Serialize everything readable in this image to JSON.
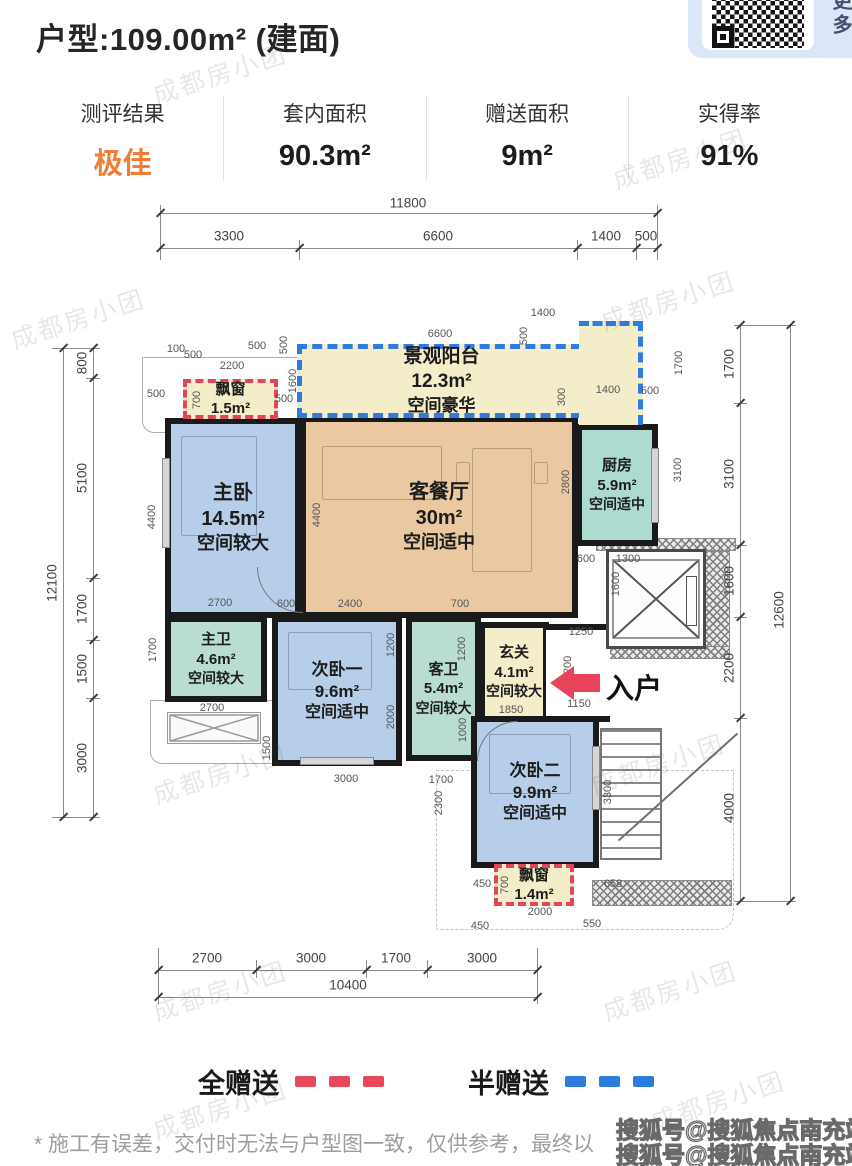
{
  "watermark_text": "成都房小团",
  "header": {
    "title": "户型:109.00m² (建面)",
    "qr_caption": "查更多"
  },
  "stats": {
    "items": [
      {
        "label": "测评结果",
        "value": "极佳",
        "color": "#ee7d35"
      },
      {
        "label": "套内面积",
        "value": "90.3m²"
      },
      {
        "label": "赠送面积",
        "value": "9m²"
      },
      {
        "label": "实得率",
        "value": "91%"
      }
    ]
  },
  "floorplan": {
    "entry_label": "入户",
    "rooms": {
      "balcony": {
        "name": "景观阳台",
        "area": "12.3m²",
        "note": "空间豪华"
      },
      "bay_top": {
        "name": "飘窗",
        "area": "1.5m²"
      },
      "master": {
        "name": "主卧",
        "area": "14.5m²",
        "note": "空间较大"
      },
      "living": {
        "name": "客餐厅",
        "area": "30m²",
        "note": "空间适中"
      },
      "kitchen": {
        "name": "厨房",
        "area": "5.9m²",
        "note": "空间适中"
      },
      "master_bath": {
        "name": "主卫",
        "area": "4.6m²",
        "note": "空间较大"
      },
      "bedroom2": {
        "name": "次卧一",
        "area": "9.6m²",
        "note": "空间适中"
      },
      "guest_bath": {
        "name": "客卫",
        "area": "5.4m²",
        "note": "空间较大"
      },
      "foyer": {
        "name": "玄关",
        "area": "4.1m²",
        "note": "空间较大"
      },
      "bedroom3": {
        "name": "次卧二",
        "area": "9.9m²",
        "note": "空间适中"
      },
      "bay_bottom": {
        "name": "飘窗",
        "area": "1.4m²"
      }
    },
    "dim_lines": [
      {
        "x": 160,
        "y": 213,
        "w": 497,
        "h": 1
      },
      {
        "x": 160,
        "y": 248,
        "w": 497,
        "h": 1
      },
      {
        "x": 158,
        "y": 970,
        "w": 379,
        "h": 1
      },
      {
        "x": 158,
        "y": 997,
        "w": 379,
        "h": 1
      },
      {
        "x": 93,
        "y": 348,
        "w": 1,
        "h": 469
      },
      {
        "x": 63,
        "y": 348,
        "w": 1,
        "h": 469
      },
      {
        "x": 740,
        "y": 325,
        "w": 1,
        "h": 576
      },
      {
        "x": 790,
        "y": 325,
        "w": 1,
        "h": 576
      },
      {
        "x": 160,
        "y": 205,
        "w": 1,
        "h": 55
      },
      {
        "x": 299,
        "y": 240,
        "w": 1,
        "h": 20
      },
      {
        "x": 577,
        "y": 240,
        "w": 1,
        "h": 20
      },
      {
        "x": 636,
        "y": 240,
        "w": 1,
        "h": 20
      },
      {
        "x": 657,
        "y": 205,
        "w": 1,
        "h": 55
      },
      {
        "x": 158,
        "y": 948,
        "w": 1,
        "h": 56
      },
      {
        "x": 256,
        "y": 960,
        "w": 1,
        "h": 18
      },
      {
        "x": 366,
        "y": 960,
        "w": 1,
        "h": 18
      },
      {
        "x": 427,
        "y": 960,
        "w": 1,
        "h": 18
      },
      {
        "x": 537,
        "y": 948,
        "w": 1,
        "h": 56
      },
      {
        "x": 52,
        "y": 348,
        "w": 48,
        "h": 1
      },
      {
        "x": 86,
        "y": 378,
        "w": 14,
        "h": 1
      },
      {
        "x": 86,
        "y": 578,
        "w": 14,
        "h": 1
      },
      {
        "x": 86,
        "y": 640,
        "w": 14,
        "h": 1
      },
      {
        "x": 86,
        "y": 698,
        "w": 14,
        "h": 1
      },
      {
        "x": 52,
        "y": 817,
        "w": 48,
        "h": 1
      },
      {
        "x": 734,
        "y": 325,
        "w": 62,
        "h": 1
      },
      {
        "x": 734,
        "y": 403,
        "w": 13,
        "h": 1
      },
      {
        "x": 734,
        "y": 545,
        "w": 13,
        "h": 1
      },
      {
        "x": 734,
        "y": 617,
        "w": 13,
        "h": 1
      },
      {
        "x": 734,
        "y": 718,
        "w": 13,
        "h": 1
      },
      {
        "x": 734,
        "y": 901,
        "w": 62,
        "h": 1
      }
    ],
    "dim_ticks": [
      {
        "x": 160,
        "y": 213
      },
      {
        "x": 657,
        "y": 213
      },
      {
        "x": 160,
        "y": 248
      },
      {
        "x": 299,
        "y": 248
      },
      {
        "x": 577,
        "y": 248
      },
      {
        "x": 636,
        "y": 248
      },
      {
        "x": 657,
        "y": 248
      },
      {
        "x": 158,
        "y": 970
      },
      {
        "x": 256,
        "y": 970
      },
      {
        "x": 366,
        "y": 970
      },
      {
        "x": 427,
        "y": 970
      },
      {
        "x": 537,
        "y": 970
      },
      {
        "x": 158,
        "y": 997
      },
      {
        "x": 537,
        "y": 997
      },
      {
        "x": 93,
        "y": 348
      },
      {
        "x": 93,
        "y": 378
      },
      {
        "x": 93,
        "y": 578
      },
      {
        "x": 93,
        "y": 640
      },
      {
        "x": 93,
        "y": 698
      },
      {
        "x": 93,
        "y": 817
      },
      {
        "x": 63,
        "y": 348
      },
      {
        "x": 63,
        "y": 817
      },
      {
        "x": 740,
        "y": 325
      },
      {
        "x": 740,
        "y": 403
      },
      {
        "x": 740,
        "y": 545
      },
      {
        "x": 740,
        "y": 617
      },
      {
        "x": 740,
        "y": 718
      },
      {
        "x": 740,
        "y": 901
      },
      {
        "x": 790,
        "y": 325
      },
      {
        "x": 790,
        "y": 901
      }
    ],
    "dim_labels": [
      {
        "t": "11800",
        "x": 408,
        "y": 203,
        "s": 1
      },
      {
        "t": "3300",
        "x": 229,
        "y": 236,
        "s": 1
      },
      {
        "t": "6600",
        "x": 438,
        "y": 236,
        "s": 1
      },
      {
        "t": "1400",
        "x": 606,
        "y": 236,
        "s": 1
      },
      {
        "t": "500",
        "x": 646,
        "y": 236,
        "s": 1
      },
      {
        "t": "2700",
        "x": 207,
        "y": 958,
        "s": 1
      },
      {
        "t": "3000",
        "x": 311,
        "y": 958,
        "s": 1
      },
      {
        "t": "1700",
        "x": 396,
        "y": 958,
        "s": 1
      },
      {
        "t": "3000",
        "x": 482,
        "y": 958,
        "s": 1
      },
      {
        "t": "10400",
        "x": 348,
        "y": 985,
        "s": 1
      },
      {
        "t": "800",
        "x": 82,
        "y": 363,
        "r": 1,
        "s": 1
      },
      {
        "t": "5100",
        "x": 82,
        "y": 478,
        "r": 1,
        "s": 1
      },
      {
        "t": "1700",
        "x": 82,
        "y": 609,
        "r": 1,
        "s": 1
      },
      {
        "t": "1500",
        "x": 82,
        "y": 669,
        "r": 1,
        "s": 1
      },
      {
        "t": "3000",
        "x": 82,
        "y": 758,
        "r": 1,
        "s": 1
      },
      {
        "t": "12100",
        "x": 52,
        "y": 583,
        "r": 1,
        "s": 1
      },
      {
        "t": "1700",
        "x": 729,
        "y": 364,
        "r": 1,
        "s": 1
      },
      {
        "t": "3100",
        "x": 729,
        "y": 474,
        "r": 1,
        "s": 1
      },
      {
        "t": "1600",
        "x": 729,
        "y": 581,
        "r": 1,
        "s": 1
      },
      {
        "t": "2200",
        "x": 729,
        "y": 668,
        "r": 1,
        "s": 1
      },
      {
        "t": "4000",
        "x": 729,
        "y": 808,
        "r": 1,
        "s": 1
      },
      {
        "t": "12600",
        "x": 779,
        "y": 610,
        "r": 1,
        "s": 1
      },
      {
        "t": "100",
        "x": 176,
        "y": 349
      },
      {
        "t": "500",
        "x": 193,
        "y": 355
      },
      {
        "t": "500",
        "x": 257,
        "y": 346
      },
      {
        "t": "2200",
        "x": 232,
        "y": 366
      },
      {
        "t": "500",
        "x": 156,
        "y": 394
      },
      {
        "t": "500",
        "x": 284,
        "y": 399
      },
      {
        "t": "700",
        "x": 197,
        "y": 400,
        "r": 1
      },
      {
        "t": "1600",
        "x": 293,
        "y": 381,
        "r": 1
      },
      {
        "t": "500",
        "x": 284,
        "y": 345,
        "r": 1
      },
      {
        "t": "6600",
        "x": 440,
        "y": 334
      },
      {
        "t": "500",
        "x": 524,
        "y": 336,
        "r": 1
      },
      {
        "t": "1400",
        "x": 543,
        "y": 313
      },
      {
        "t": "1700",
        "x": 679,
        "y": 363,
        "r": 1
      },
      {
        "t": "300",
        "x": 562,
        "y": 397,
        "r": 1
      },
      {
        "t": "1400",
        "x": 608,
        "y": 390
      },
      {
        "t": "500",
        "x": 650,
        "y": 391
      },
      {
        "t": "4400",
        "x": 152,
        "y": 517,
        "r": 1
      },
      {
        "t": "4400",
        "x": 317,
        "y": 515,
        "r": 1
      },
      {
        "t": "2800",
        "x": 566,
        "y": 482,
        "r": 1
      },
      {
        "t": "3100",
        "x": 678,
        "y": 470,
        "r": 1
      },
      {
        "t": "2700",
        "x": 220,
        "y": 603
      },
      {
        "t": "600",
        "x": 286,
        "y": 604
      },
      {
        "t": "2400",
        "x": 350,
        "y": 604
      },
      {
        "t": "700",
        "x": 460,
        "y": 604
      },
      {
        "t": "600",
        "x": 586,
        "y": 559
      },
      {
        "t": "1300",
        "x": 628,
        "y": 559
      },
      {
        "t": "1600",
        "x": 616,
        "y": 584,
        "r": 1
      },
      {
        "t": "1250",
        "x": 581,
        "y": 632
      },
      {
        "t": "1200",
        "x": 568,
        "y": 668,
        "r": 1
      },
      {
        "t": "1850",
        "x": 511,
        "y": 710
      },
      {
        "t": "1150",
        "x": 579,
        "y": 704
      },
      {
        "t": "1200",
        "x": 391,
        "y": 645,
        "r": 1
      },
      {
        "t": "2000",
        "x": 391,
        "y": 717,
        "r": 1
      },
      {
        "t": "1200",
        "x": 462,
        "y": 649,
        "r": 1
      },
      {
        "t": "1000",
        "x": 463,
        "y": 730,
        "r": 1
      },
      {
        "t": "2700",
        "x": 212,
        "y": 708
      },
      {
        "t": "1500",
        "x": 267,
        "y": 748,
        "r": 1
      },
      {
        "t": "1700",
        "x": 153,
        "y": 650,
        "r": 1
      },
      {
        "t": "3000",
        "x": 346,
        "y": 779
      },
      {
        "t": "1700",
        "x": 441,
        "y": 780
      },
      {
        "t": "2300",
        "x": 439,
        "y": 803,
        "r": 1
      },
      {
        "t": "3300",
        "x": 608,
        "y": 792,
        "r": 1
      },
      {
        "t": "450",
        "x": 482,
        "y": 884
      },
      {
        "t": "700",
        "x": 505,
        "y": 885,
        "r": 1
      },
      {
        "t": "658",
        "x": 613,
        "y": 884
      },
      {
        "t": "2000",
        "x": 540,
        "y": 912
      },
      {
        "t": "450",
        "x": 480,
        "y": 926
      },
      {
        "t": "550",
        "x": 592,
        "y": 924
      }
    ]
  },
  "legend": {
    "items": [
      {
        "label": "全赠送",
        "color": "#e8485c"
      },
      {
        "label": "半赠送",
        "color": "#2e7bdf"
      }
    ]
  },
  "footer": {
    "disclaimer": "* 施工有误差，交付时无法与户型图一致，仅供参考，最终以",
    "watermark_line1": "搜狐号@搜狐焦点南充站",
    "watermark_line2": "搜狐号@搜狐焦点南充站"
  }
}
